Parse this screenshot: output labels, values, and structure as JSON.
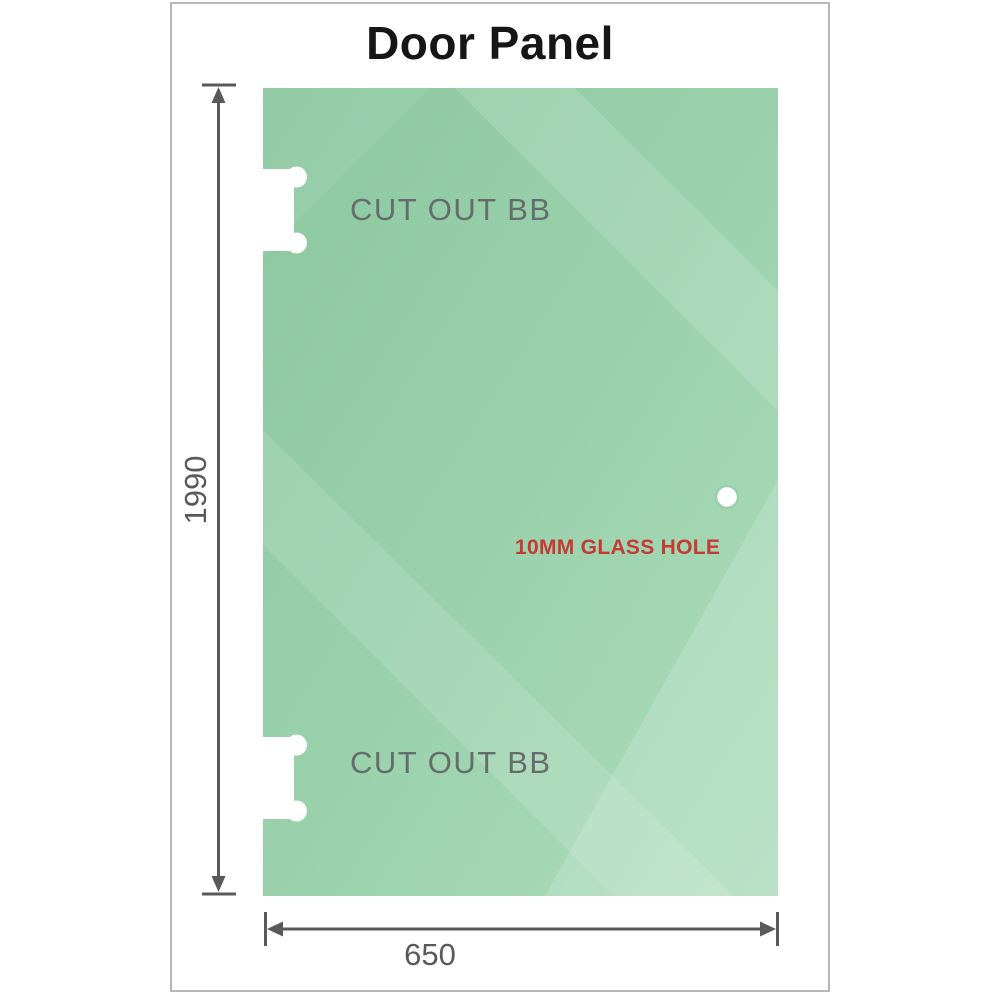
{
  "title": "Door Panel",
  "diagram": {
    "height_label": "1990",
    "width_label": "650",
    "cutout_top_label": "CUT OUT BB",
    "cutout_bottom_label": "CUT OUT BB",
    "hole_label": "10MM GLASS HOLE"
  },
  "colors": {
    "glass_base": "#8cc7a0",
    "glass_light": "#aedcbc",
    "dimension_gray": "#58595b",
    "hole_label_red": "#c53a32",
    "cutout_label_gray": "#646c6c",
    "frame_border": "#b6b8b7"
  }
}
